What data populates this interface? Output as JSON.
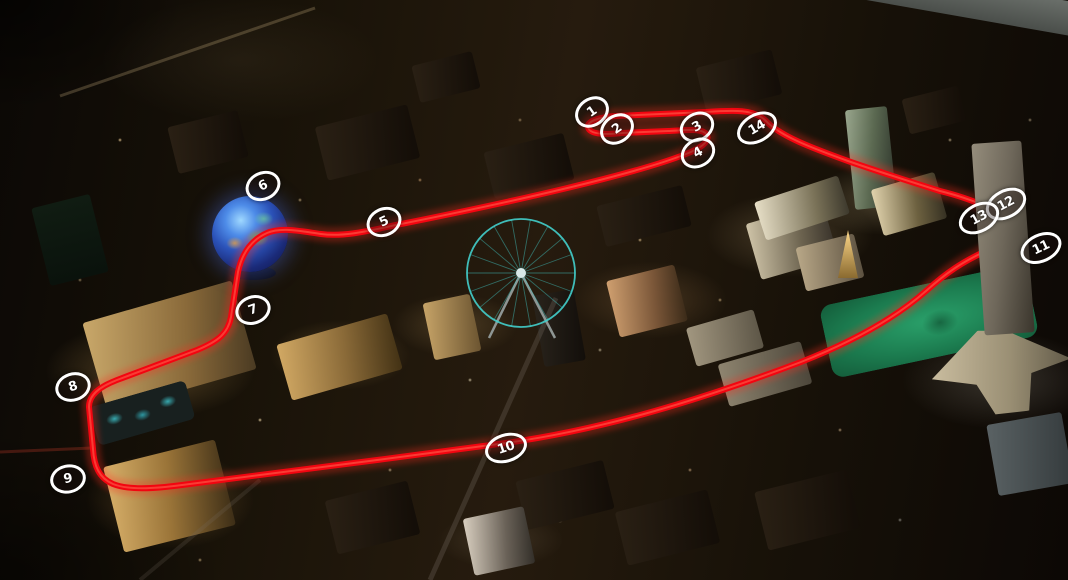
{
  "scene": {
    "location": "Las Vegas Strip aerial night view",
    "type": "street-circuit-map"
  },
  "colors": {
    "track_red": "#f20510",
    "track_glow": "#ff2e1e",
    "marker_white": "#ffffff",
    "sphere_blue": "#3f6fd8",
    "ferris_wheel_teal": "#43cfcc",
    "lawn_green": "#1f8a58",
    "night_base": "#16100a"
  },
  "track": {
    "path": "M 940 191 C 905 180 868 168 848 161 C 812 148 780 136 766 121 C 754 109 734 110 706 112 L 616 116 C 600 117 587 121 588 127 C 589 134 603 135 622 133 L 668 131 C 688 130 703 128 707 135 C 710 142 699 149 686 154 C 636 174 512 202 396 225 C 368 231 344 237 321 234 C 299 231 281 227 267 233 C 251 240 242 253 238 272 L 231 317 C 228 333 219 341 197 350 L 117 380 C 99 387 89 395 89 407 L 93 449 C 94 466 99 478 113 484 C 128 490 152 489 182 485 C 262 475 402 457 506 443 C 606 429 703 399 801 362 C 862 338 901 313 926 291 C 946 273 962 262 986 251 C 1004 243 1011 231 1003 220 C 995 209 972 199 940 191 Z"
  },
  "turn_markers": [
    {
      "label": "1",
      "x": 592,
      "y": 112,
      "rot": -35
    },
    {
      "label": "2",
      "x": 617,
      "y": 129,
      "rot": -35
    },
    {
      "label": "3",
      "x": 697,
      "y": 127,
      "rot": -30
    },
    {
      "label": "4",
      "x": 698,
      "y": 153,
      "rot": -30
    },
    {
      "label": "5",
      "x": 384,
      "y": 222,
      "rot": -25
    },
    {
      "label": "6",
      "x": 263,
      "y": 186,
      "rot": -25
    },
    {
      "label": "7",
      "x": 253,
      "y": 310,
      "rot": -20
    },
    {
      "label": "8",
      "x": 73,
      "y": 387,
      "rot": -18
    },
    {
      "label": "9",
      "x": 68,
      "y": 479,
      "rot": -12
    },
    {
      "label": "10",
      "x": 506,
      "y": 448,
      "rot": -18
    },
    {
      "label": "11",
      "x": 1041,
      "y": 248,
      "rot": -25
    },
    {
      "label": "12",
      "x": 1006,
      "y": 204,
      "rot": -28
    },
    {
      "label": "13",
      "x": 979,
      "y": 218,
      "rot": -28
    },
    {
      "label": "14",
      "x": 757,
      "y": 128,
      "rot": -30
    }
  ],
  "landmarks": [
    {
      "id": "msg-sphere"
    },
    {
      "id": "high-roller-ferris-wheel"
    },
    {
      "id": "venetian-resort"
    },
    {
      "id": "venetian-pools"
    },
    {
      "id": "treasure-island-hotel"
    },
    {
      "id": "mirage-hotel"
    },
    {
      "id": "flamingo-hotel"
    },
    {
      "id": "paris-eiffel-tower"
    },
    {
      "id": "trump-tower"
    },
    {
      "id": "wynn-hotel"
    },
    {
      "id": "palazzo-hotel"
    },
    {
      "id": "fontainebleau-tower"
    },
    {
      "id": "golf-course-lawn"
    },
    {
      "id": "bellagio-hotel"
    },
    {
      "id": "caesars-palace"
    },
    {
      "id": "bellagio-lake"
    },
    {
      "id": "airport-runway"
    }
  ]
}
